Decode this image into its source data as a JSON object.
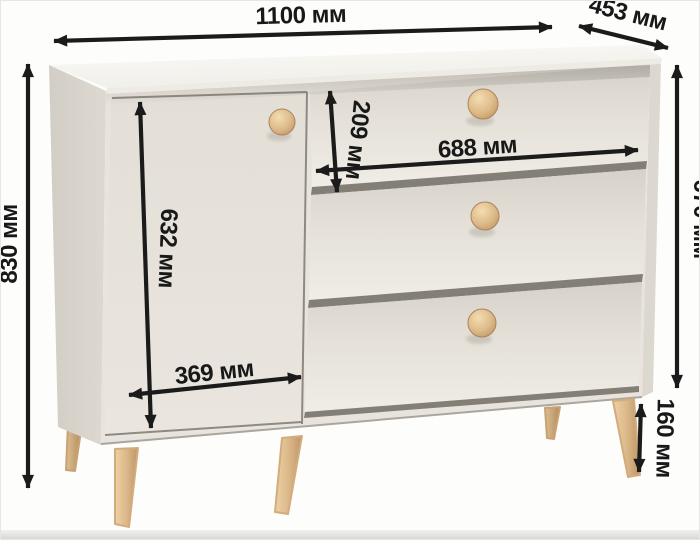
{
  "diagram": {
    "type": "furniture-dimension-diagram",
    "subject": "sideboard with one door, three drawers, round wooden knobs and tapered wooden legs",
    "unit": "мм",
    "dimensions": {
      "overall_width": {
        "label": "1100 мм",
        "value": 1100
      },
      "depth": {
        "label": "453 мм",
        "value": 453
      },
      "overall_height": {
        "label": "830 мм",
        "value": 830
      },
      "body_height": {
        "label": "670 мм",
        "value": 670
      },
      "door_height": {
        "label": "632 мм",
        "value": 632
      },
      "top_drawer_height": {
        "label": "209 мм",
        "value": 209
      },
      "drawer_width": {
        "label": "688 мм",
        "value": 688
      },
      "door_width": {
        "label": "369 мм",
        "value": 369
      },
      "leg_height": {
        "label": "160 мм",
        "value": 160
      }
    },
    "colors": {
      "dimension_ink": "#1b1b1b",
      "cabinet_top": "#f7f5f1",
      "cabinet_front": "#e8e4dd",
      "cabinet_side": "#d8d4cc",
      "gap_shadow": "#837f76",
      "wood_light": "#eed2a6",
      "wood_dark": "#bf9566",
      "background": "#fdfdfc"
    }
  }
}
